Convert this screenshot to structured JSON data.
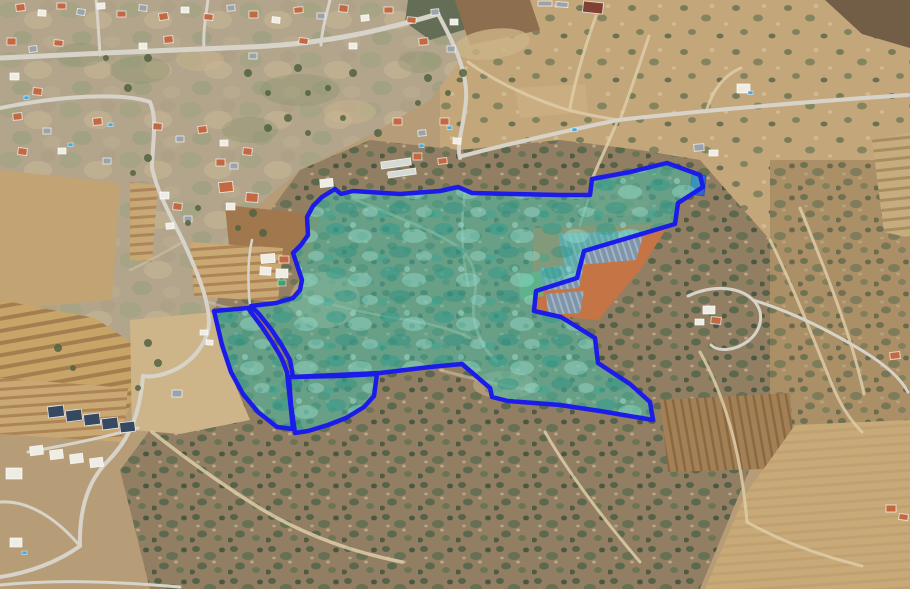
{
  "map": {
    "description": "Satellite aerial view of a hillside village, fields and scrubland with a blue land-parcel boundary overlay filled in semi-transparent teal",
    "overlay": {
      "stroke_color": "#1515e8",
      "stroke_width": 4.5,
      "fill_base": "rgba(62,186,167,0.52)",
      "parcels": [
        {
          "id": "parcel-main",
          "points": [
            [
              322,
              197
            ],
            [
              335,
              189
            ],
            [
              341,
              194
            ],
            [
              353,
              191
            ],
            [
              400,
              194
            ],
            [
              440,
              191
            ],
            [
              458,
              187
            ],
            [
              472,
              193
            ],
            [
              560,
              195
            ],
            [
              590,
              195
            ],
            [
              592,
              179
            ],
            [
              630,
              172
            ],
            [
              667,
              163
            ],
            [
              700,
              175
            ],
            [
              703,
              187
            ],
            [
              678,
              203
            ],
            [
              675,
              224
            ],
            [
              584,
              251
            ],
            [
              577,
              278
            ],
            [
              536,
              291
            ],
            [
              534,
              311
            ],
            [
              561,
              317
            ],
            [
              595,
              338
            ],
            [
              598,
              363
            ],
            [
              630,
              384
            ],
            [
              650,
              402
            ],
            [
              653,
              420
            ],
            [
              600,
              411
            ],
            [
              560,
              405
            ],
            [
              508,
              401
            ],
            [
              492,
              397
            ],
            [
              490,
              388
            ],
            [
              462,
              364
            ],
            [
              430,
              367
            ],
            [
              380,
              373
            ],
            [
              293,
              377
            ],
            [
              290,
              360
            ],
            [
              281,
              344
            ],
            [
              271,
              329
            ],
            [
              259,
              314
            ],
            [
              251,
              306
            ],
            [
              276,
              303
            ],
            [
              293,
              298
            ],
            [
              300,
              290
            ],
            [
              302,
              280
            ],
            [
              297,
              265
            ],
            [
              293,
              253
            ],
            [
              301,
              245
            ],
            [
              308,
              235
            ],
            [
              307,
              217
            ],
            [
              313,
              206
            ]
          ]
        },
        {
          "id": "parcel-west-lobe",
          "points": [
            [
              214,
              311
            ],
            [
              248,
              308
            ],
            [
              253,
              315
            ],
            [
              262,
              327
            ],
            [
              272,
              342
            ],
            [
              281,
              357
            ],
            [
              287,
              372
            ],
            [
              290,
              400
            ],
            [
              293,
              429
            ],
            [
              277,
              427
            ],
            [
              258,
              412
            ],
            [
              243,
              394
            ],
            [
              231,
              372
            ],
            [
              222,
              345
            ]
          ]
        },
        {
          "id": "parcel-south-lobe",
          "points": [
            [
              289,
              377
            ],
            [
              340,
              376
            ],
            [
              377,
              374
            ],
            [
              374,
              396
            ],
            [
              364,
              407
            ],
            [
              346,
              418
            ],
            [
              328,
              425
            ],
            [
              308,
              431
            ],
            [
              295,
              433
            ],
            [
              291,
              405
            ]
          ]
        }
      ]
    },
    "terrain_palette": {
      "base_tan": "#b59a73",
      "village_ground": "#b1a289",
      "scrub_dark": "#8f7b5e",
      "field_tan": "#c9a66f",
      "field_brown": "#9e7348",
      "road_grey": "#d6d2c8",
      "roof_orange": "#c2653c",
      "roof_grey": "#98a0a8",
      "roof_dark_blue": "#31435c",
      "pool_blue": "#3fa9dc",
      "panel_blue_grey": "#8fa6ba",
      "dirt_orange": "#c4713f",
      "strip_dirt": "#a5754d"
    }
  }
}
